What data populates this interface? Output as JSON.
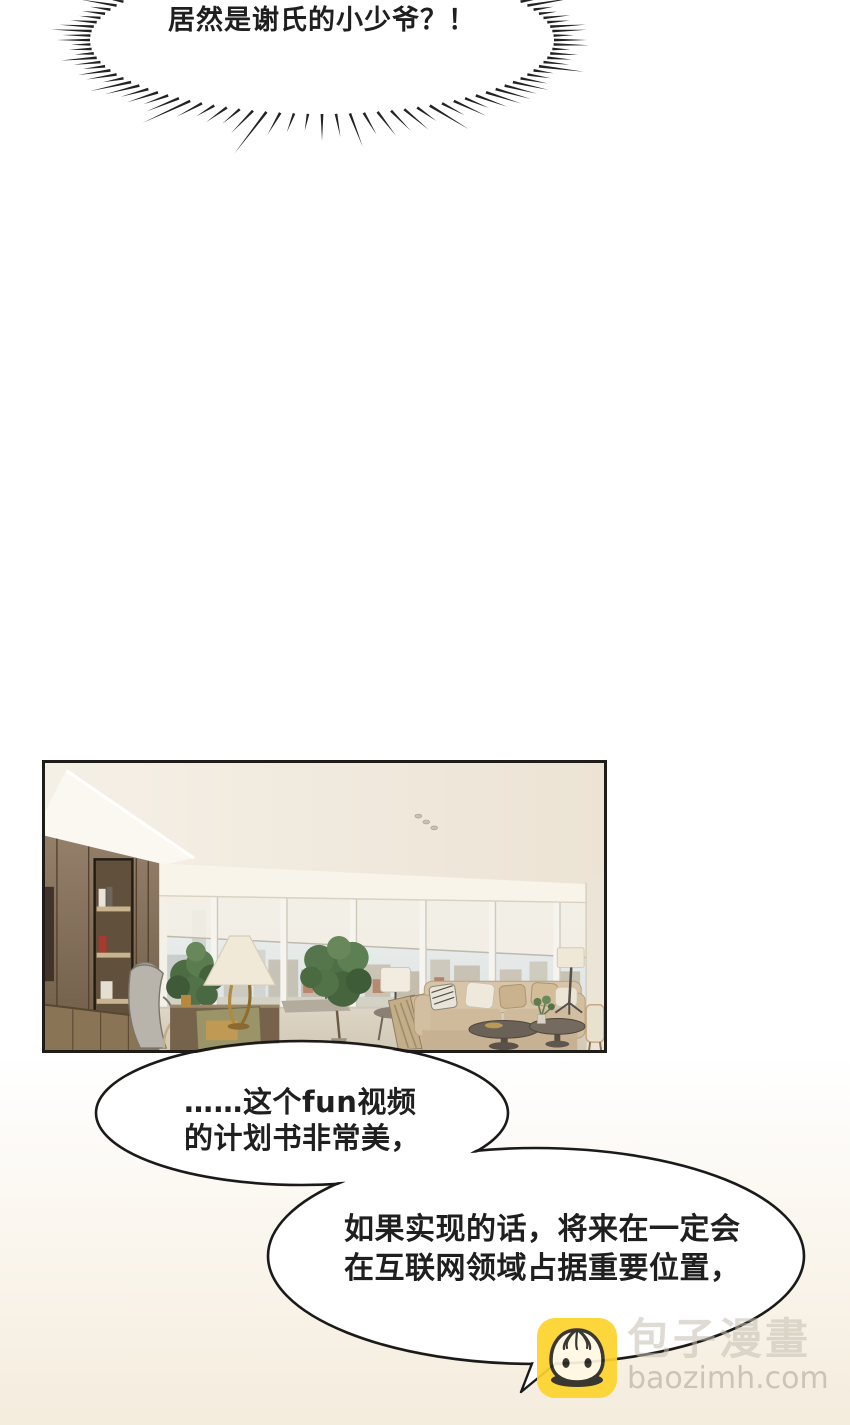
{
  "shout": {
    "text": "居然是谢氏的小少爷？！"
  },
  "bubbles": [
    {
      "lines": [
        "……这个fun视频",
        "的计划书非常美，"
      ]
    },
    {
      "lines": [
        "如果实现的话，将来在一定会",
        "在互联网领域占据重要位置，"
      ]
    }
  ],
  "watermark": {
    "site_name": "包子漫畫",
    "site_url": "baozimh.com"
  },
  "colors": {
    "burst_lines": "#232323",
    "bubble_outline": "#1a1a1a",
    "bubble_fill": "#ffffff",
    "text": "#1f1f1f",
    "brand_yellow": "#fcd32b",
    "panel_border": "#1f1d1a",
    "page_bottom_tint": "#f4ecdd",
    "scene_ceiling": "#f3ede2",
    "scene_wood_wall": "#8a7456",
    "scene_window_sky": "#e6ebec",
    "scene_sofa": "#d5c2a5",
    "scene_plant": "#527248",
    "scene_floor": "#d8d0c0"
  }
}
